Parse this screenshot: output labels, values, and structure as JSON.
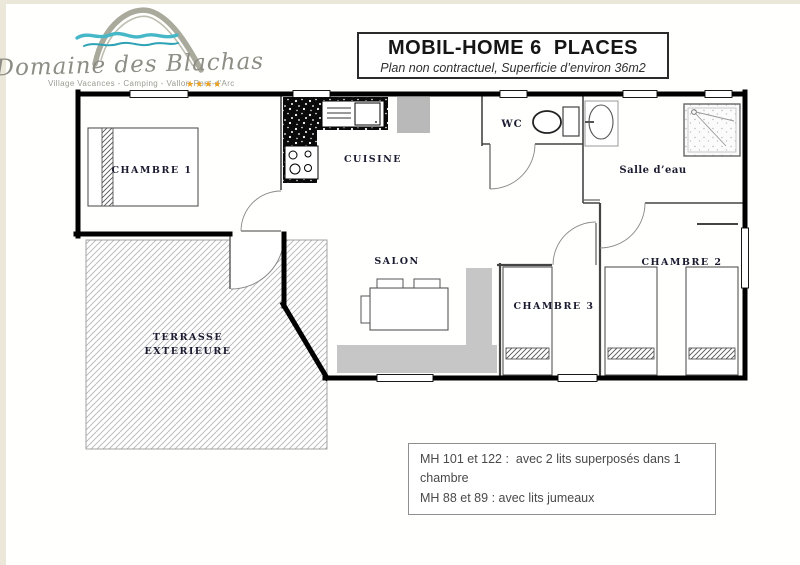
{
  "logo": {
    "brand": "Domaine des Blachas",
    "tagline": "Village Vacances - Camping - Vallon-Pont-d'Arc",
    "stars": "★★★★"
  },
  "header": {
    "title": "MOBIL-HOME 6  PLACES",
    "subtitle": "Plan non contractuel, Superficie d’environ 36m2"
  },
  "plan": {
    "rooms": {
      "chambre1": "CHAMBRE 1",
      "cuisine": "CUISINE",
      "wc": "WC",
      "salle_eau": "Salle d’eau",
      "salon": "SALON",
      "chambre3": "CHAMBRE 3",
      "chambre2": "CHAMBRE 2",
      "terrasse_line1": "TERRASSE",
      "terrasse_line2": "EXTERIEURE"
    }
  },
  "notes": {
    "line1": "MH 101 et 122 :  avec 2 lits superposés dans 1 chambre",
    "line2": "MH 88 et 89 : avec lits jumeaux"
  },
  "colors": {
    "wall": "#000000",
    "interior_wall": "#444444",
    "sofa_gray": "#c6c6c6",
    "fridge_gray": "#b9b9b9",
    "logo_teal": "#45b7c7",
    "logo_gray": "#8d8d85",
    "star_orange": "#eda21f",
    "label_ink": "#1b1b30"
  }
}
